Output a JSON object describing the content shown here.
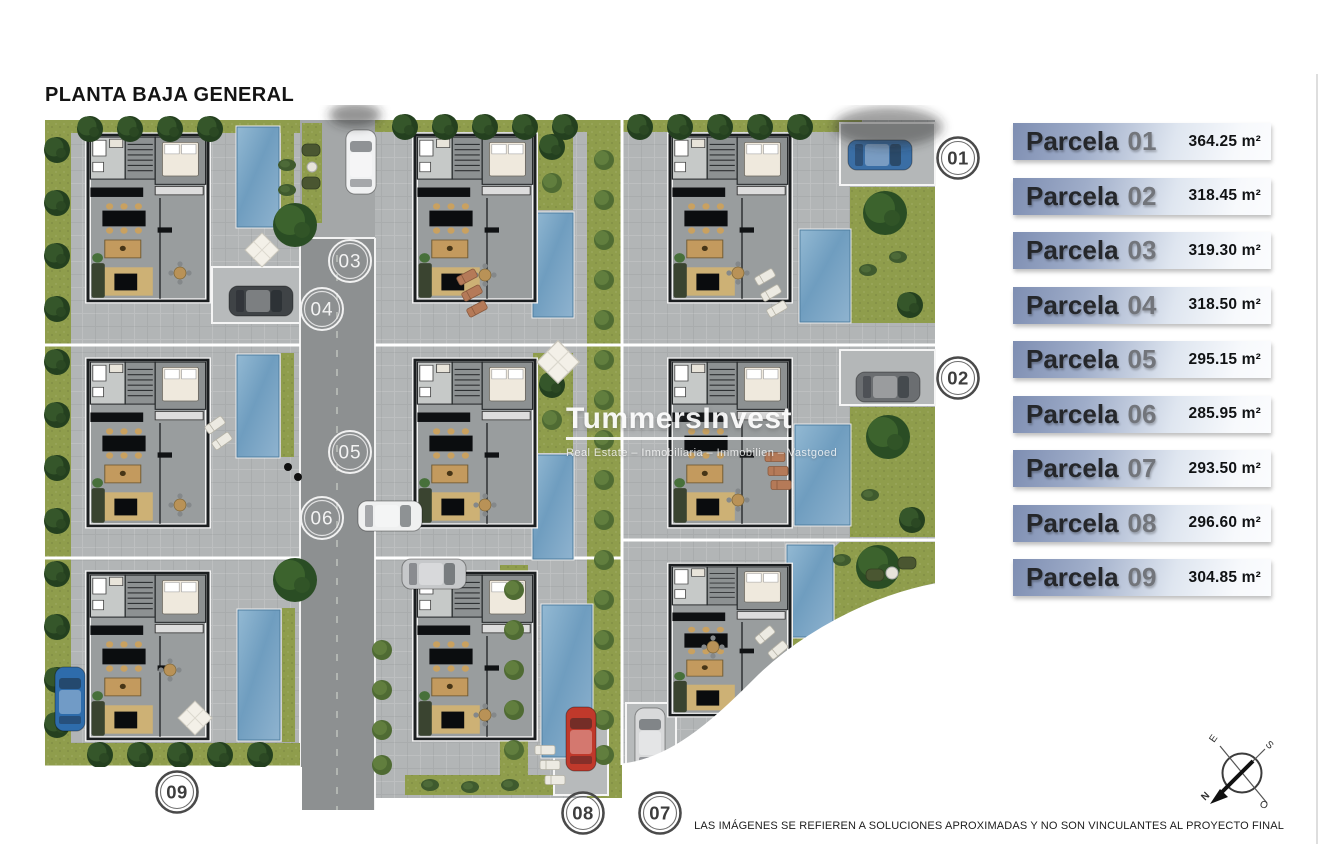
{
  "page": {
    "title": "PLANTA BAJA GENERAL",
    "disclaimer": "LAS IMÁGENES SE REFIEREN A SOLUCIONES APROXIMADAS Y NO SON VINCULANTES AL PROYECTO FINAL"
  },
  "watermark": {
    "brand": "TummersInvest",
    "tagline": "Real Estate – Inmobiliaria – Immobilien – Vastgoed"
  },
  "legend": {
    "items": [
      {
        "label": "Parcela",
        "number": "01",
        "area": "364.25 m²"
      },
      {
        "label": "Parcela",
        "number": "02",
        "area": "318.45 m²"
      },
      {
        "label": "Parcela",
        "number": "03",
        "area": "319.30 m²"
      },
      {
        "label": "Parcela",
        "number": "04",
        "area": "318.50 m²"
      },
      {
        "label": "Parcela",
        "number": "05",
        "area": "295.15 m²"
      },
      {
        "label": "Parcela",
        "number": "06",
        "area": "285.95 m²"
      },
      {
        "label": "Parcela",
        "number": "07",
        "area": "293.50 m²"
      },
      {
        "label": "Parcela",
        "number": "08",
        "area": "296.60 m²"
      },
      {
        "label": "Parcela",
        "number": "09",
        "area": "304.85 m²"
      }
    ]
  },
  "plan": {
    "road_markers": [
      {
        "number": "03"
      },
      {
        "number": "04"
      },
      {
        "number": "05"
      },
      {
        "number": "06"
      }
    ],
    "plot_markers": [
      {
        "number": "01"
      },
      {
        "number": "02"
      },
      {
        "number": "07"
      },
      {
        "number": "08"
      },
      {
        "number": "09"
      }
    ]
  },
  "compass": {
    "north": "N",
    "south": "S",
    "east": "E",
    "west": "O"
  },
  "colors": {
    "legend_bar_start": "#7e8eb2",
    "legend_bar_end": "#fbfcfe",
    "grass": "#8f9d4c",
    "pool": "#6f9dbf",
    "road": "#8d9091"
  }
}
